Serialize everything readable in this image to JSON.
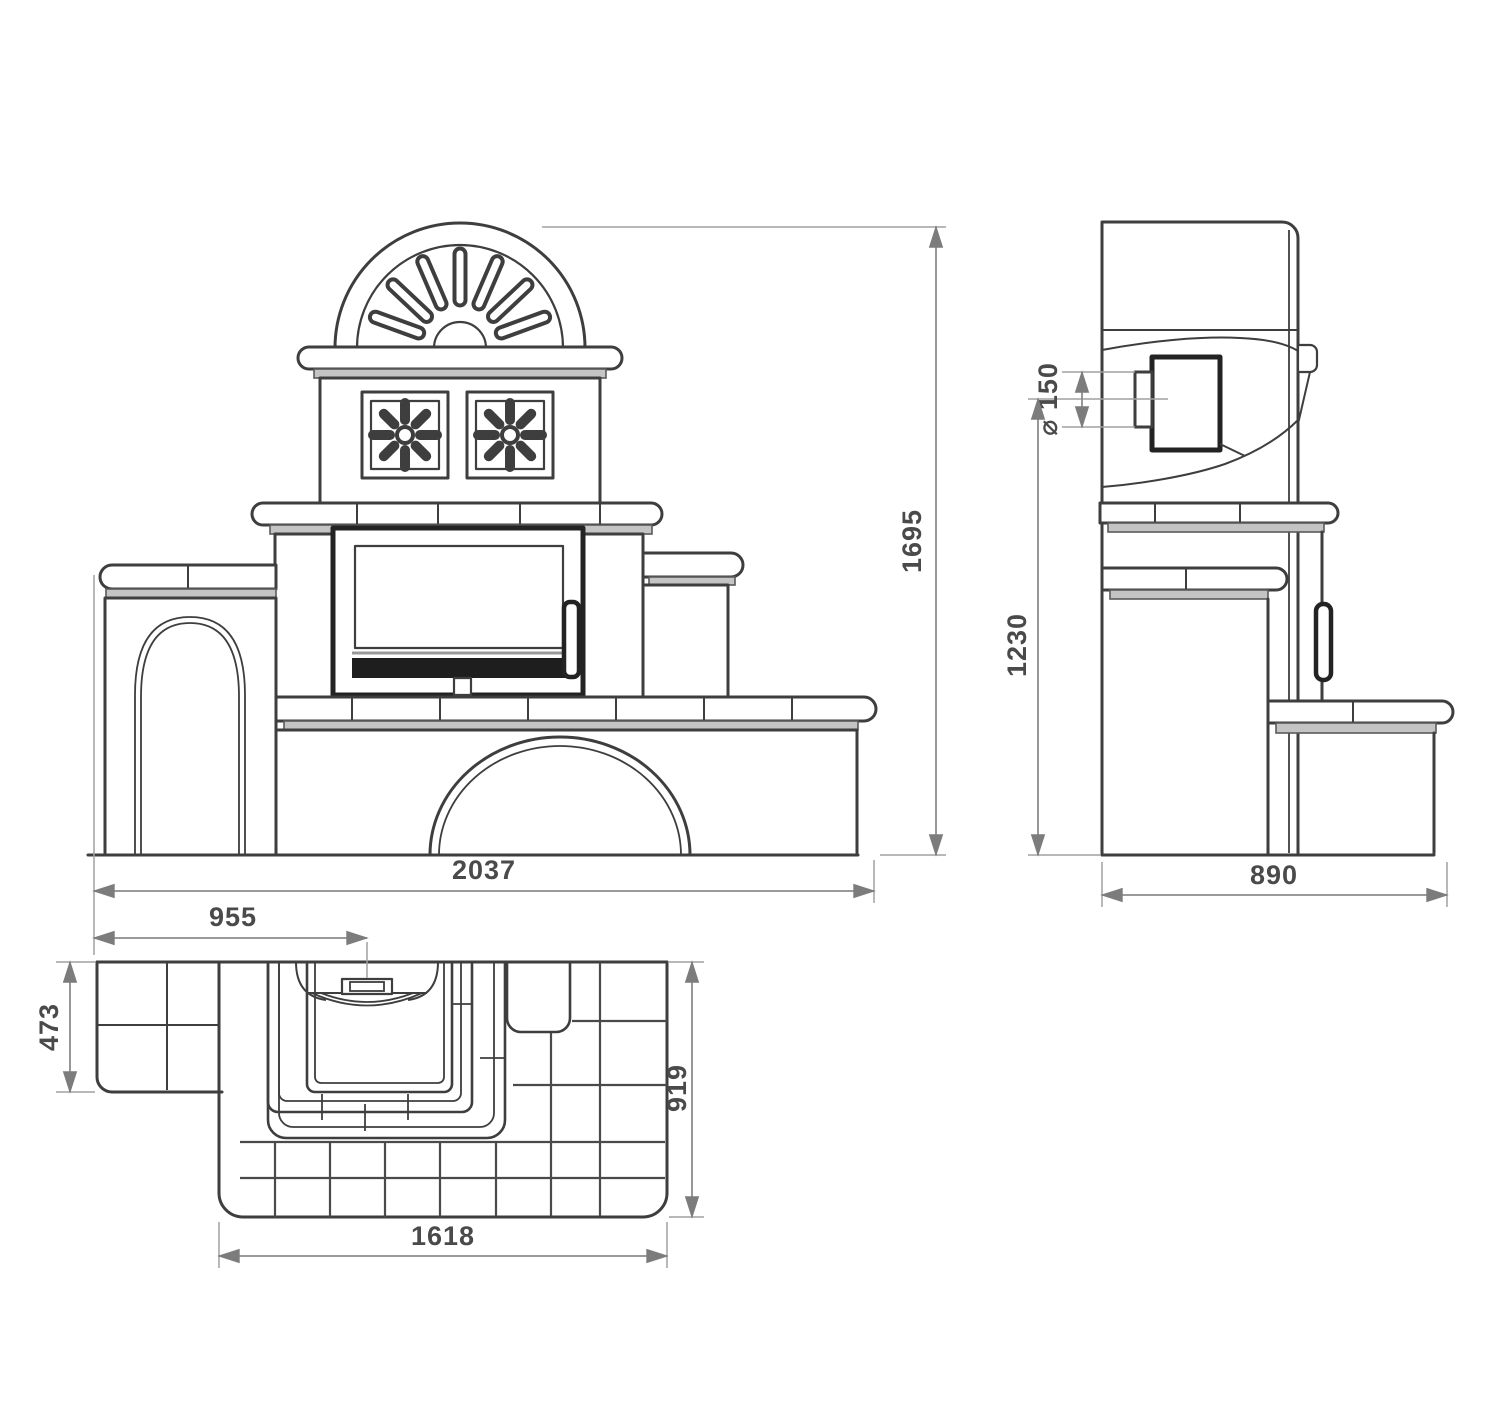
{
  "drawing": {
    "subject": "tiled masonry stove — three-view dimensioned technical drawing (front elevation, side elevation, top plan)",
    "background": "#ffffff",
    "line_color": "#3e3e3e",
    "dim_color": "#8c8c8c",
    "dims": {
      "front_width": "2037",
      "front_height": "1695",
      "side_depth": "890",
      "side_flue_axis_height": "1230",
      "flue_diameter": "⌀ 150",
      "plan_bench_width": "955",
      "plan_bench_depth": "473",
      "plan_body_depth": "919",
      "plan_body_width": "1618"
    }
  }
}
